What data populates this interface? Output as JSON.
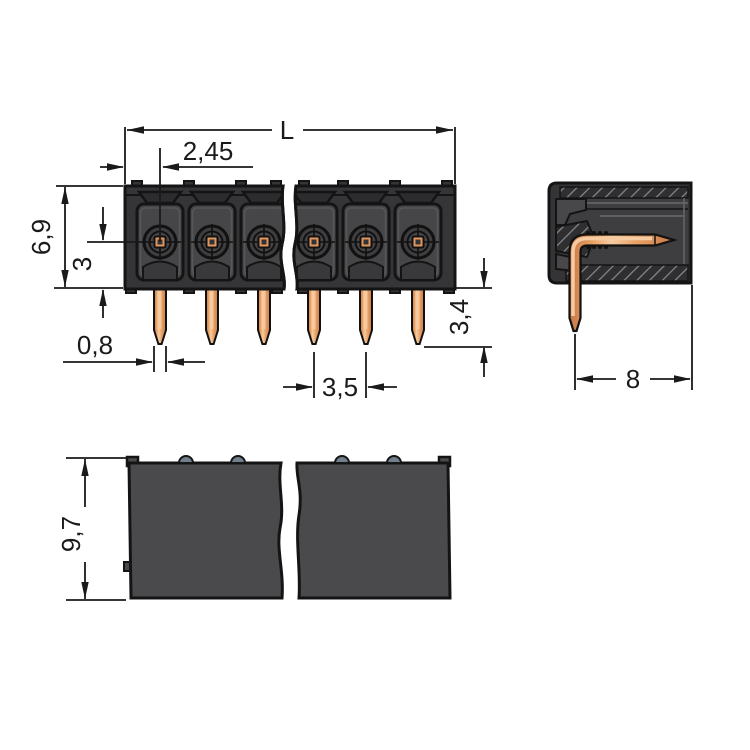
{
  "drawing": {
    "kind": "technical dimension drawing",
    "subject": "THT male pin header with angled solder pins, front / side / bottom views",
    "views": {
      "front": "front-view",
      "side": "side-view-section",
      "bottom": "bottom-view"
    },
    "pin_count_shown": 6,
    "background": "#ffffff",
    "line_color": "#1a1a1a"
  },
  "dimensions": {
    "front": {
      "overall_length": "L",
      "pin1_offset": "2,45",
      "housing_height": "6,9",
      "pin_axis_height": "3",
      "pin_width": "0,8",
      "pin_pitch": "3,5",
      "pin_length": "3,4"
    },
    "side": {
      "pin_depth": "8"
    },
    "bottom": {
      "overall_depth": "9,7"
    }
  },
  "colors": {
    "housing_dark": "#353537",
    "housing_panel": "#464648",
    "housing_inset": "#3e3e40",
    "trapezoid_dark": "#2c2c2e",
    "hatch_line": "#8a8a8c",
    "copper_pad": "#e2975f",
    "copper_mid": "#e8a064",
    "copper_highlight": "#f6cba1",
    "copper_shadow": "#c67a48",
    "bump_gray": "#72808d",
    "line": "#1a1a1a"
  }
}
